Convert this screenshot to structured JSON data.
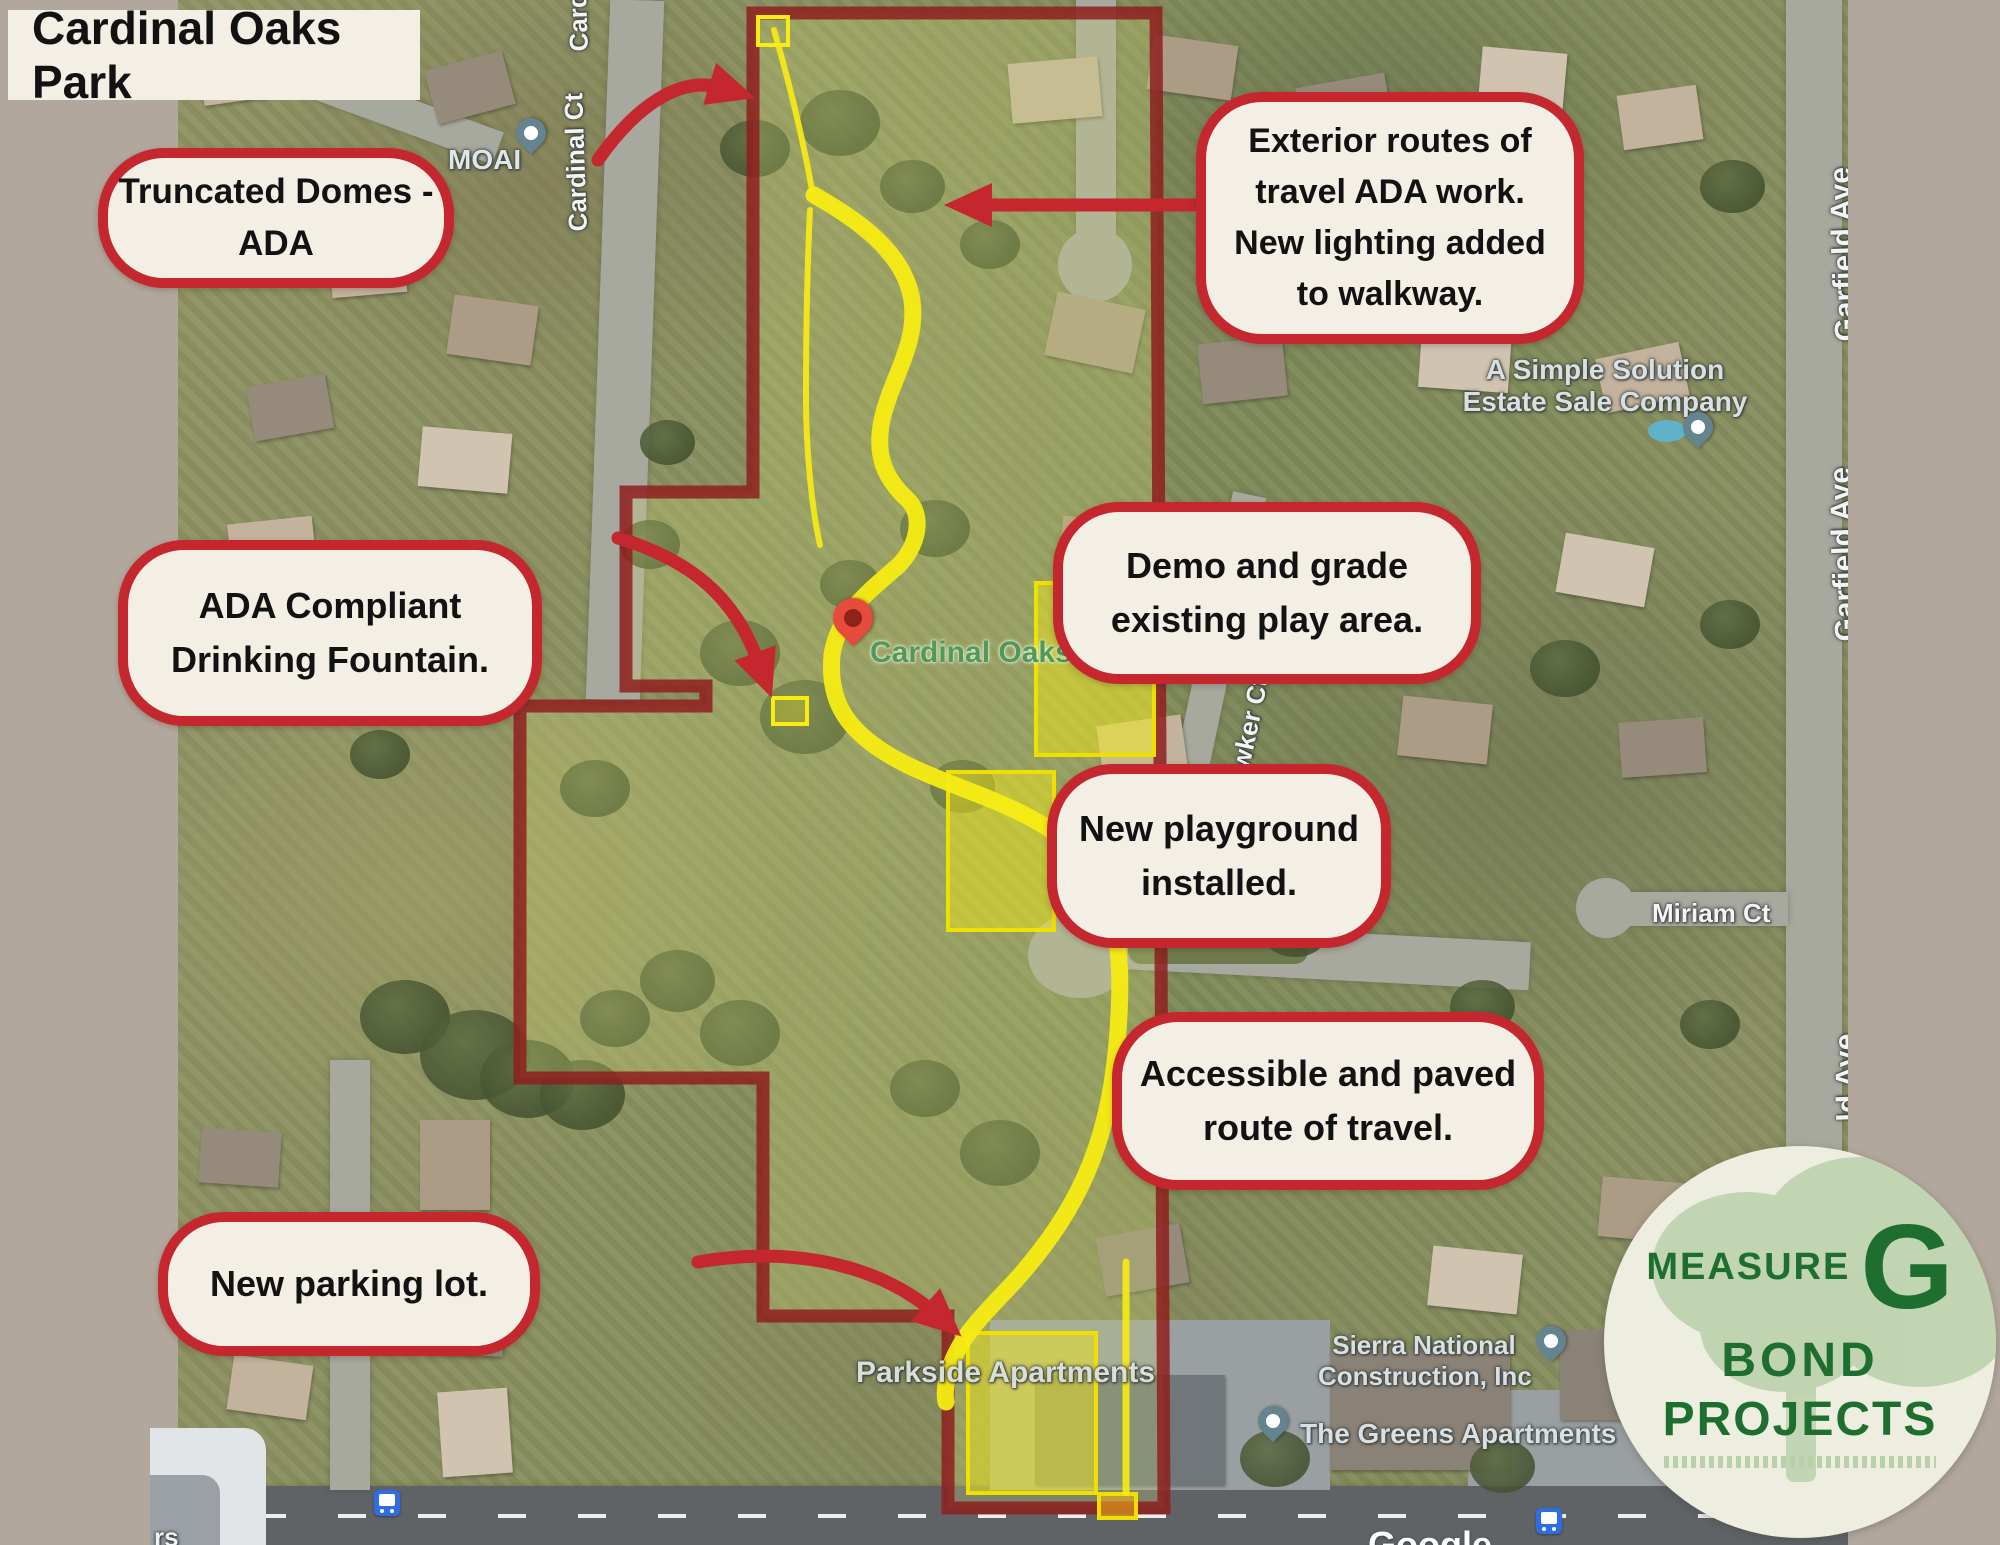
{
  "title": "Cardinal Oaks Park",
  "callouts": {
    "truncated": {
      "l1": "Truncated Domes -",
      "l2": "ADA"
    },
    "exterior": {
      "l1": "Exterior routes of",
      "l2": "travel ADA work.",
      "l3": "New lighting added",
      "l4": "to walkway."
    },
    "fountain": {
      "l1": "ADA Compliant",
      "l2": "Drinking Fountain."
    },
    "demo": {
      "l1": "Demo and grade",
      "l2": "existing play area."
    },
    "playground": {
      "l1": "New playground",
      "l2": "installed."
    },
    "route": {
      "l1": "Accessible and paved",
      "l2": "route of travel."
    },
    "parking": {
      "l1": "New parking lot."
    }
  },
  "map_labels": {
    "moai": "MOAI",
    "cardinal_ct": "Cardinal Ct",
    "garfield_ave": "Garfield Ave",
    "garfield_partial": "ld Ave",
    "simple_solution_1": "A Simple Solution",
    "simple_solution_2": "Estate Sale Company",
    "park_name": "Cardinal Oaks Park",
    "bowker": "Bowker Ct",
    "miriam": "Miriam Ct",
    "parkside": "Parkside Apartments",
    "sierra_1": "Sierra National",
    "sierra_2": "Construction, Inc",
    "greens": "The Greens Apartments",
    "google": "Google",
    "partial_rs": "rs"
  },
  "logo": {
    "measure": "MEASURE",
    "g": "G",
    "bond": "BOND",
    "projects": "PROJECTS"
  },
  "colors": {
    "frame": "#b2a79c",
    "callout_bg": "#f3efe4",
    "callout_border": "#c4272e",
    "boundary_red": "#8e1f1f",
    "route_yellow": "#f7ec13",
    "logo_green": "#1e6f2f",
    "bus_blue": "#2f6de0",
    "pin_red": "#e74b3c",
    "pin_slate": "#64858f"
  }
}
